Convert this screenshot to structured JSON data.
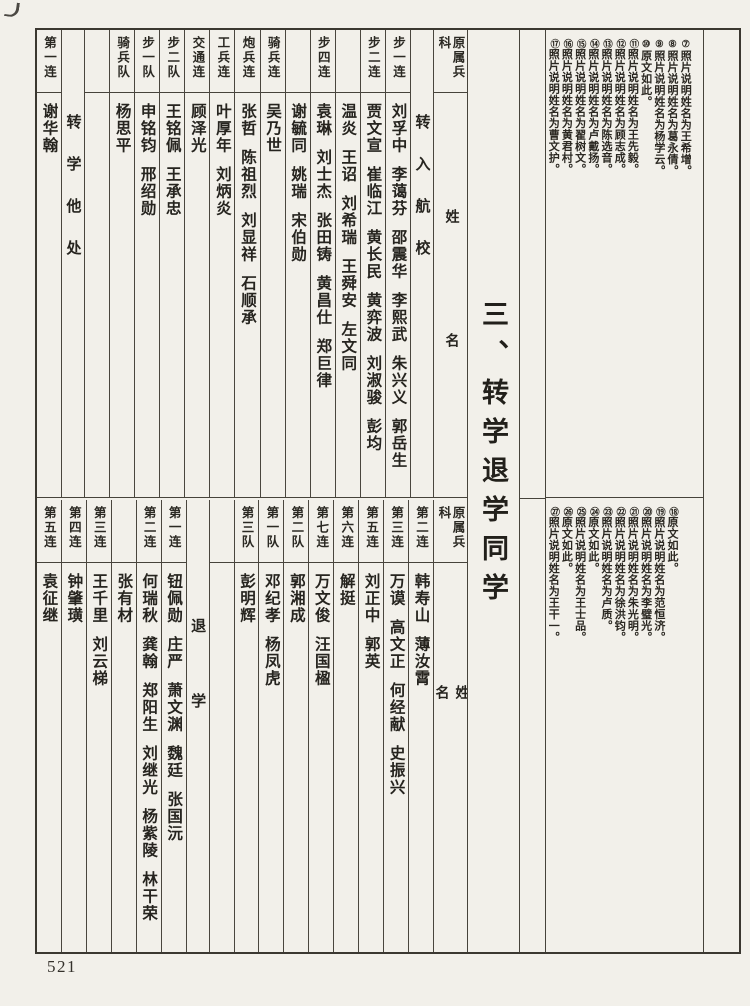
{
  "page": {
    "number": "521",
    "title": "三、转学退学同学"
  },
  "top_table": {
    "columns": [
      {
        "type": "legend",
        "header": "原属兵科",
        "name_label": "姓名"
      },
      {
        "type": "label",
        "label": "转入航校"
      },
      {
        "type": "unit",
        "header": "步一连",
        "names": [
          "刘孚中",
          "李蔼芬",
          "邵震华",
          "李熙武",
          "朱兴义",
          "郭岳生"
        ]
      },
      {
        "type": "unit",
        "header": "步二连",
        "names": [
          "贾文宣",
          "崔临江",
          "黄长民",
          "黄弈波",
          "刘淑骏",
          "彭均"
        ]
      },
      {
        "type": "overflow",
        "header": "",
        "names": [
          "温炎",
          "王诏",
          "刘希瑞",
          "王舜安",
          "左文同"
        ]
      },
      {
        "type": "unit",
        "header": "步四连",
        "names": [
          "袁琳",
          "刘士杰",
          "张田铸",
          "黄昌仕",
          "郑巨律"
        ]
      },
      {
        "type": "overflow",
        "header": "",
        "names": [
          "谢毓同",
          "姚瑞",
          "宋伯勋"
        ]
      },
      {
        "type": "unit",
        "header": "骑兵连",
        "names": [
          "吴乃世"
        ]
      },
      {
        "type": "unit",
        "header": "炮兵连",
        "names": [
          "张哲",
          "陈祖烈",
          "刘显祥",
          "石顺承"
        ]
      },
      {
        "type": "unit",
        "header": "工兵连",
        "names": [
          "叶厚年",
          "刘炳炎"
        ]
      },
      {
        "type": "unit",
        "header": "交通连",
        "names": [
          "顾泽光"
        ]
      },
      {
        "type": "unit",
        "header": "步二队",
        "names": [
          "王铭佩",
          "王承忠"
        ]
      },
      {
        "type": "unit",
        "header": "步一队",
        "names": [
          "申铭钧",
          "邢绍勋"
        ]
      },
      {
        "type": "unit",
        "header": "骑兵队",
        "names": [
          "杨思平"
        ]
      },
      {
        "type": "spacer"
      },
      {
        "type": "label",
        "label": "转学他处"
      },
      {
        "type": "unit",
        "header": "第一连",
        "names": [
          "谢华翰"
        ]
      }
    ]
  },
  "bottom_table": {
    "columns": [
      {
        "type": "legend",
        "header": "原属兵科",
        "name_label": "姓名"
      },
      {
        "type": "unit",
        "header": "第二连",
        "names": [
          "韩寿山",
          "薄汝霄"
        ]
      },
      {
        "type": "unit",
        "header": "第三连",
        "names": [
          "万谟",
          "高文正",
          "何经献",
          "史振兴"
        ]
      },
      {
        "type": "unit",
        "header": "第五连",
        "names": [
          "刘正中",
          "郭英"
        ]
      },
      {
        "type": "unit",
        "header": "第六连",
        "names": [
          "解挺"
        ]
      },
      {
        "type": "unit",
        "header": "第七连",
        "names": [
          "万文俊",
          "汪国楹"
        ]
      },
      {
        "type": "unit",
        "header": "第二队",
        "names": [
          "郭湘成"
        ]
      },
      {
        "type": "unit",
        "header": "第一队",
        "names": [
          "邓纪孝",
          "杨凤虎"
        ]
      },
      {
        "type": "unit",
        "header": "第三队",
        "names": [
          "彭明辉"
        ]
      },
      {
        "type": "spacer"
      },
      {
        "type": "label",
        "label": "退学"
      },
      {
        "type": "unit",
        "header": "第一连",
        "names": [
          "钮佩勋",
          "庄严",
          "萧文渊",
          "魏廷",
          "张国沅"
        ]
      },
      {
        "type": "unit",
        "header": "第二连",
        "names": [
          "何瑞秋",
          "龚翰",
          "郑阳生",
          "刘继光",
          "杨紫陵",
          "林干荣"
        ]
      },
      {
        "type": "overflow",
        "header": "",
        "names": [
          "张有材"
        ]
      },
      {
        "type": "unit",
        "header": "第三连",
        "names": [
          "王千里",
          "刘云梯"
        ]
      },
      {
        "type": "unit",
        "header": "第四连",
        "names": [
          "钟肇璜"
        ]
      },
      {
        "type": "unit",
        "header": "第五连",
        "names": [
          "袁征继"
        ]
      }
    ]
  },
  "footnotes": {
    "top": [
      {
        "num": "⑦",
        "text": "照片说明姓名为王希增。"
      },
      {
        "num": "⑧",
        "text": "照片说明姓名为葛永倩。"
      },
      {
        "num": "⑨",
        "text": "照片说明姓名为杨学云。"
      },
      {
        "num": "⑩",
        "text": "原文如此。"
      },
      {
        "num": "⑪",
        "text": "照片说明姓名为王先毅。"
      },
      {
        "num": "⑫",
        "text": "照片说明姓名为顾志成。"
      },
      {
        "num": "⑬",
        "text": "照片说明姓名为陈选音。"
      },
      {
        "num": "⑭",
        "text": "照片说明姓名为卢戴扬。"
      },
      {
        "num": "⑮",
        "text": "照片说明姓名为翟树文。"
      },
      {
        "num": "⑯",
        "text": "照片说明姓名为黄君村。"
      },
      {
        "num": "⑰",
        "text": "照片说明姓名为曹文护。"
      }
    ],
    "bottom": [
      {
        "num": "⑱",
        "text": "原文如此。"
      },
      {
        "num": "⑲",
        "text": "照片说明姓名为范恒济。"
      },
      {
        "num": "⑳",
        "text": "照片说明姓名为李璧光。"
      },
      {
        "num": "㉑",
        "text": "照片说明姓名为朱光明。"
      },
      {
        "num": "㉒",
        "text": "照片说明姓名为徐洪钧。"
      },
      {
        "num": "㉓",
        "text": "照片说明姓名为卢质。"
      },
      {
        "num": "㉔",
        "text": "原文如此。"
      },
      {
        "num": "㉕",
        "text": "照片说明姓名为王士品。"
      },
      {
        "num": "㉖",
        "text": "原文如此。"
      },
      {
        "num": "㉗",
        "text": "照片说明姓名为王干一。"
      }
    ]
  }
}
